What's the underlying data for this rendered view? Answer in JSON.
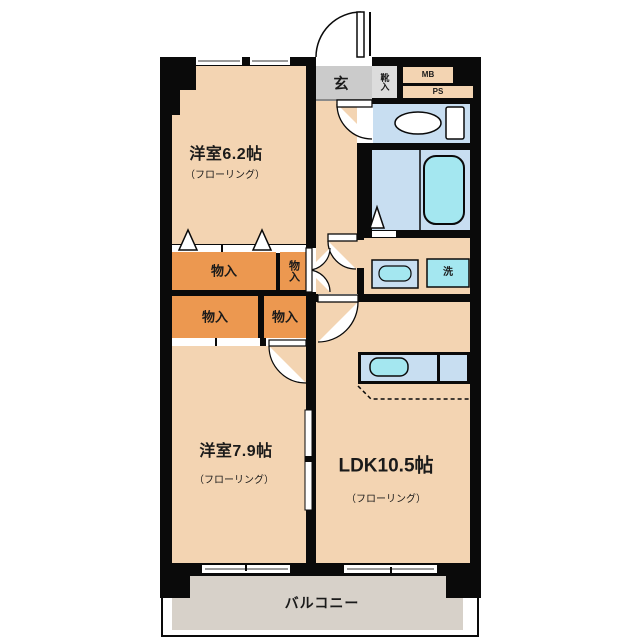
{
  "plan_type": "floor-plan",
  "rooms": {
    "bedroom1": {
      "name": "洋室6.2帖",
      "floor_note": "（フローリング）"
    },
    "bedroom2": {
      "name": "洋室7.9帖",
      "floor_note": "（フローリング）"
    },
    "ldk": {
      "name": "LDK10.5帖",
      "floor_note": "（フローリング）"
    },
    "balcony": {
      "name": "バルコニー"
    },
    "entrance": {
      "name": "玄"
    },
    "shoe_cabinet": {
      "name": "靴入"
    }
  },
  "closets": {
    "upper_wide": {
      "name": "物入"
    },
    "upper_side": {
      "name": "物入"
    },
    "lower_left": {
      "name": "物入"
    },
    "lower_right": {
      "name": "物入"
    }
  },
  "utility": {
    "meter_box": "MB",
    "pipe_space": "PS",
    "washing_machine": "洗"
  },
  "colors": {
    "wall": "#0a0a0a",
    "room_floor": "#f3d4b2",
    "closet": "#ec9850",
    "entrance_floor": "#cbcbcb",
    "water_area": "#c8def1",
    "fixture_cyan": "#a4e7f0",
    "balcony_floor": "#d7d1c9"
  }
}
